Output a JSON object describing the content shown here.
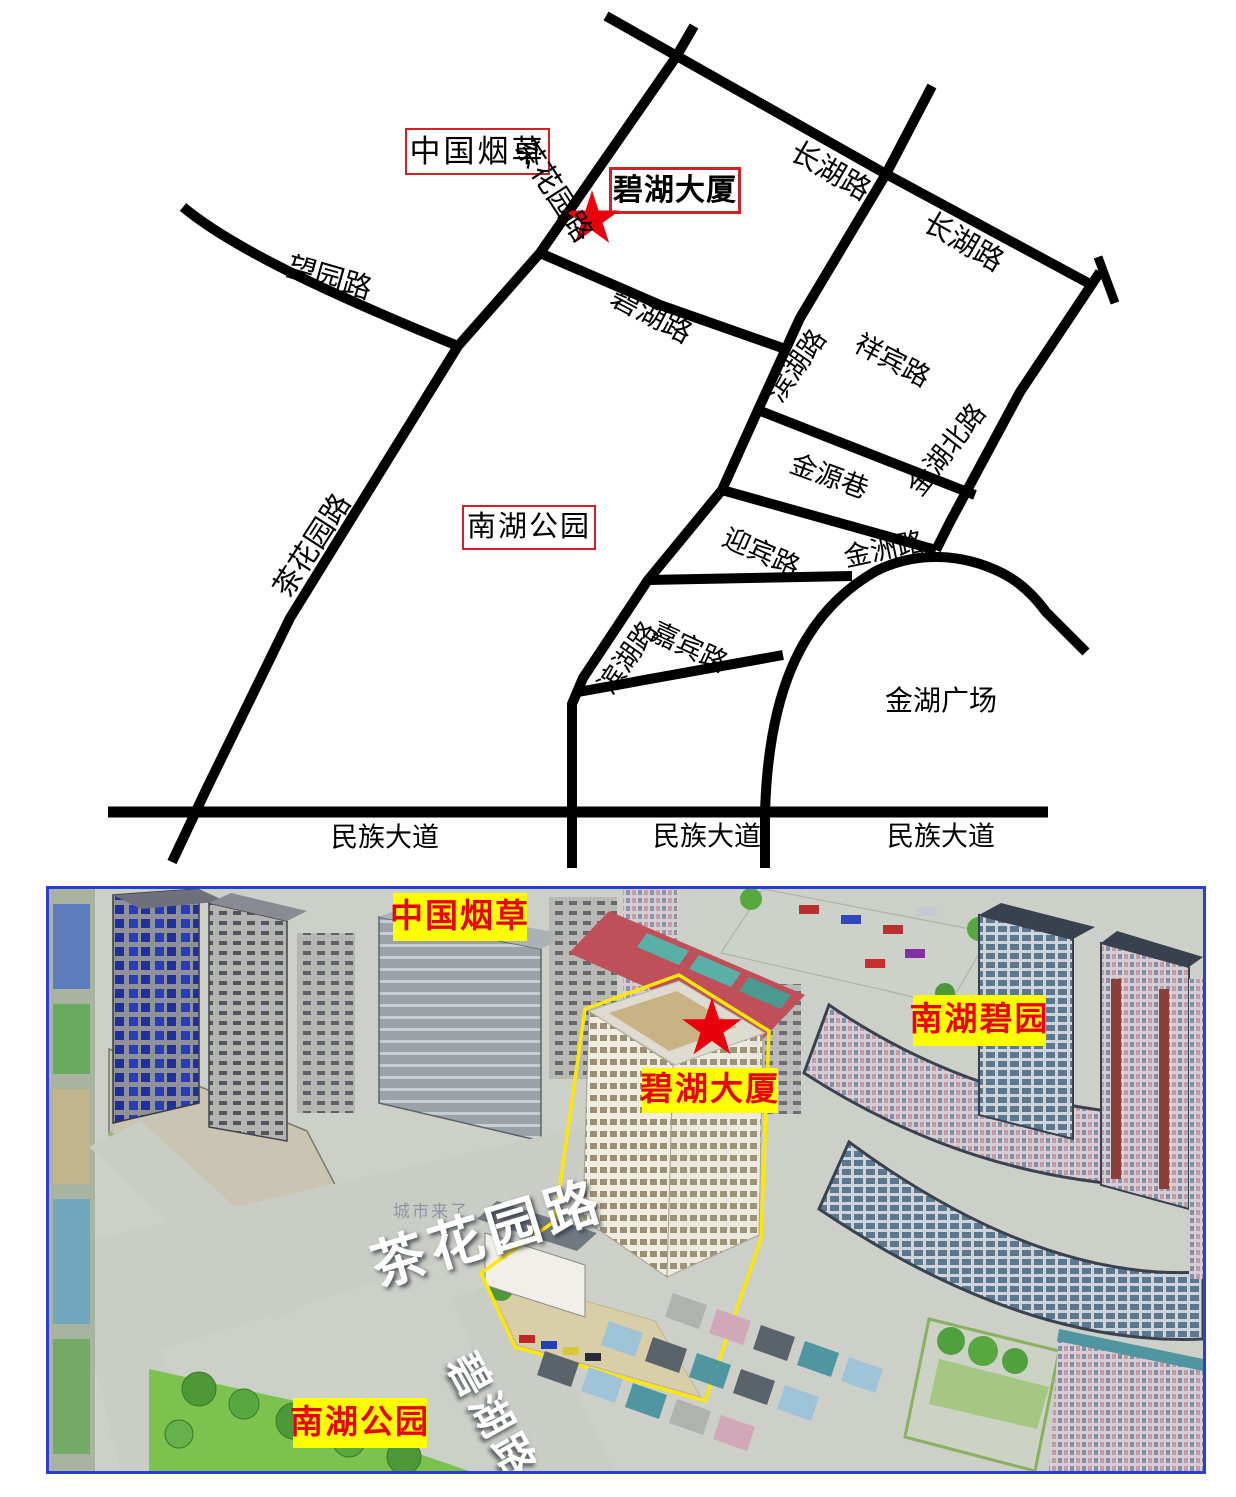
{
  "top_map": {
    "landmark_boxes": {
      "china_tobacco": "中国烟草",
      "bihu_building": "碧湖大厦",
      "nanhu_park": "南湖公园"
    },
    "road_labels": {
      "chahuayuan_1": "茶花园路",
      "chahuayuan_2": "茶花园路",
      "wangyuan": "望园路",
      "bihu": "碧湖路",
      "changhu_1": "长湖路",
      "changhu_2": "长湖路",
      "binhu_1": "滨湖路",
      "binhu_2": "滨湖路",
      "xiangbin": "祥宾路",
      "jinhu_north": "金湖北路",
      "jinyuan": "金源巷",
      "yingbin": "迎宾路",
      "jiabin": "嘉宾路",
      "jinzhou": "金洲路",
      "minzu_1": "民族大道",
      "minzu_2": "民族大道",
      "minzu_3": "民族大道"
    },
    "area_labels": {
      "jinhu_plaza": "金湖广场"
    },
    "icons": {
      "star": "★"
    },
    "colors": {
      "road": "#000000",
      "star": "#e8000d",
      "box_border": "#cf2127",
      "text": "#000000"
    }
  },
  "bottom_map": {
    "tags": {
      "china_tobacco": "中国烟草",
      "nanhu_biyuan": "南湖碧园",
      "bihu_building": "碧湖大厦",
      "nanhu_park": "南湖公园"
    },
    "road_texts": {
      "chahuayuan": "茶花园路",
      "bihu": "碧湖路"
    },
    "watermark": "城市来了",
    "icons": {
      "star": "★"
    },
    "colors": {
      "tag_bg": "#ffff00",
      "tag_text": "#e60012",
      "frame_border": "#2b3fd0",
      "road_text": "#ffffff"
    }
  }
}
